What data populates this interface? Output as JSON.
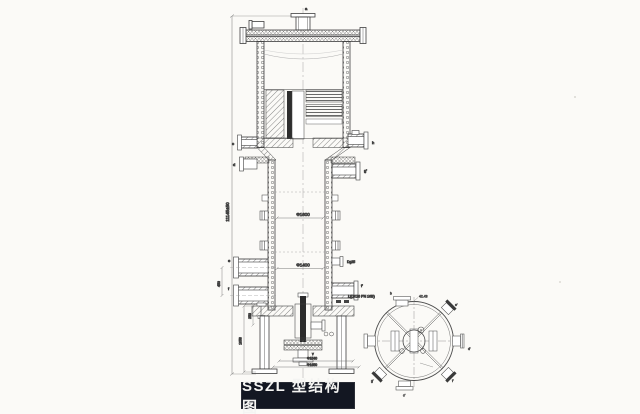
{
  "title_block": {
    "label": "SSZL 型结构图",
    "bg_color": "#131722",
    "text_color": "#f4f4f2"
  },
  "elevation": {
    "overall_height_dim": "11145±50",
    "dia_upper": "Φ1600",
    "dia_lower": "Φ1400",
    "dia_base_inner": "Φ1540",
    "dia_base_outer": "Φ1650",
    "skirt_height": "1058",
    "stub_offset": "253",
    "nozzle_pitch": "450",
    "stub_size": "Dg25",
    "flange_note": "L(DK16 PN 16B)",
    "marks": {
      "top": "a",
      "left_upper": "c",
      "left_mid": "d",
      "right_upper": "h",
      "right_mid": "g'",
      "left_lower_1": "e",
      "left_lower_2": "f",
      "right_lower": "f'",
      "bottom": "v"
    }
  },
  "plan_view": {
    "angle_label": "42.43",
    "marks": {
      "top": "b",
      "top_right": "e'",
      "right": "d'",
      "bottom_right": "f'",
      "bottom": "c'",
      "bottom_left": "g'"
    }
  }
}
